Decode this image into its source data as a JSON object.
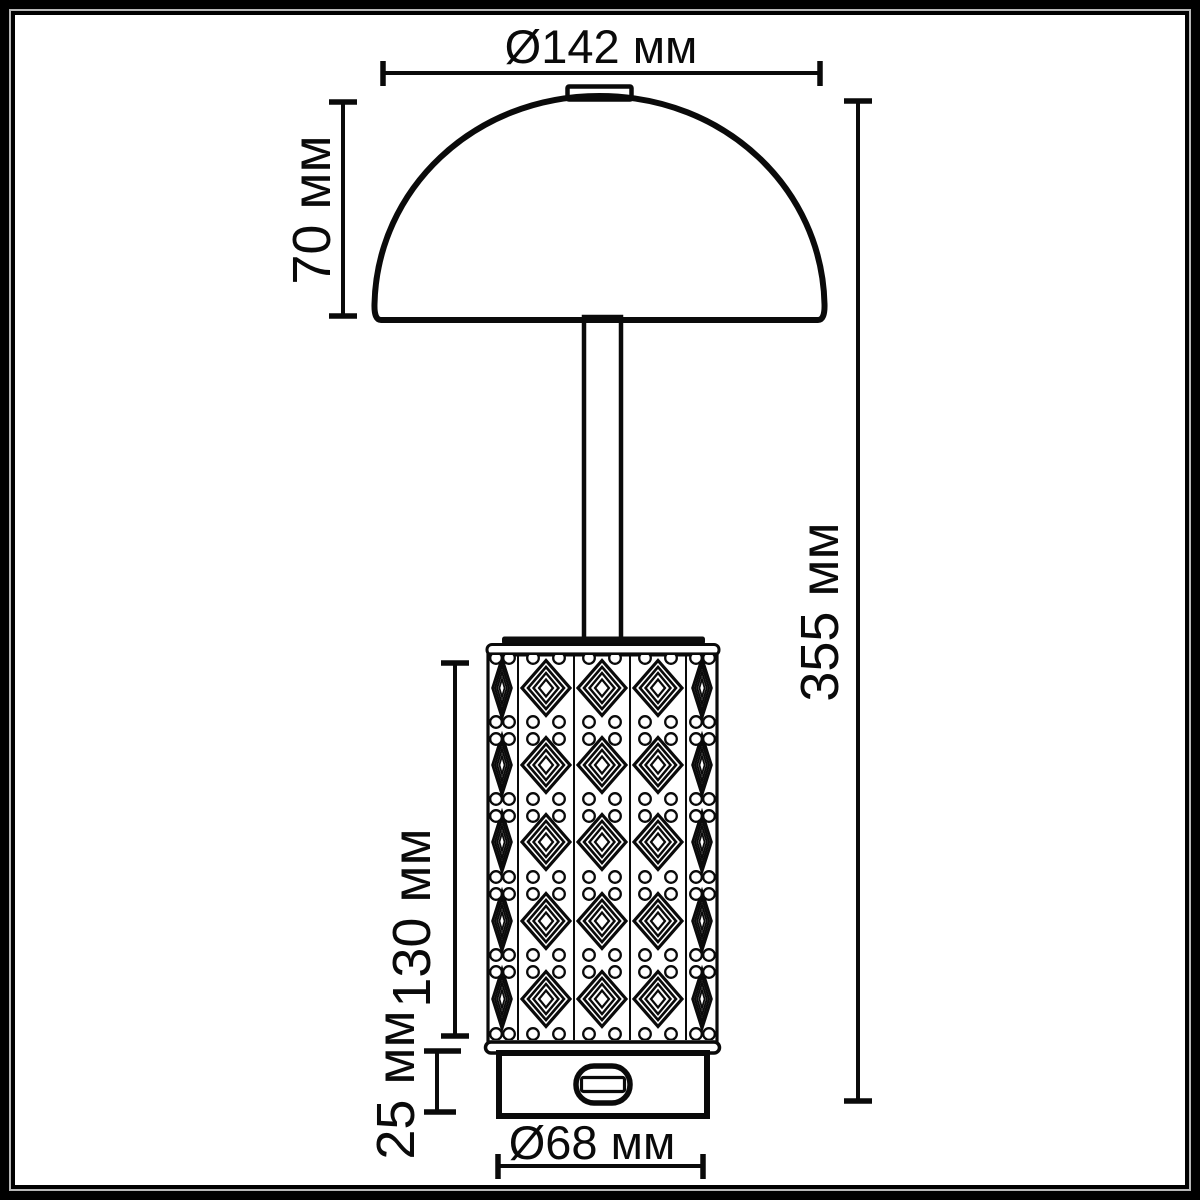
{
  "units": "мм",
  "dimensions": {
    "shade_diameter": {
      "label": "Ø142 мм",
      "value": 142,
      "kind": "diameter",
      "applies_to": "dome-shade"
    },
    "shade_height": {
      "label": "70 мм",
      "value": 70,
      "kind": "height",
      "applies_to": "dome-shade"
    },
    "total_height": {
      "label": "355 мм",
      "value": 355,
      "kind": "height",
      "applies_to": "whole-lamp"
    },
    "body_height": {
      "label": "130 мм",
      "value": 130,
      "kind": "height",
      "applies_to": "crystal-cylinder"
    },
    "base_height": {
      "label": "25 мм",
      "value": 25,
      "kind": "height",
      "applies_to": "base"
    },
    "base_diameter": {
      "label": "Ø68 мм",
      "value": 68,
      "kind": "diameter",
      "applies_to": "base"
    }
  },
  "colors": {
    "line": "#0a0a0a",
    "background": "#ffffff",
    "frame": "#000000",
    "pinstripe": "#b8b8b8"
  }
}
